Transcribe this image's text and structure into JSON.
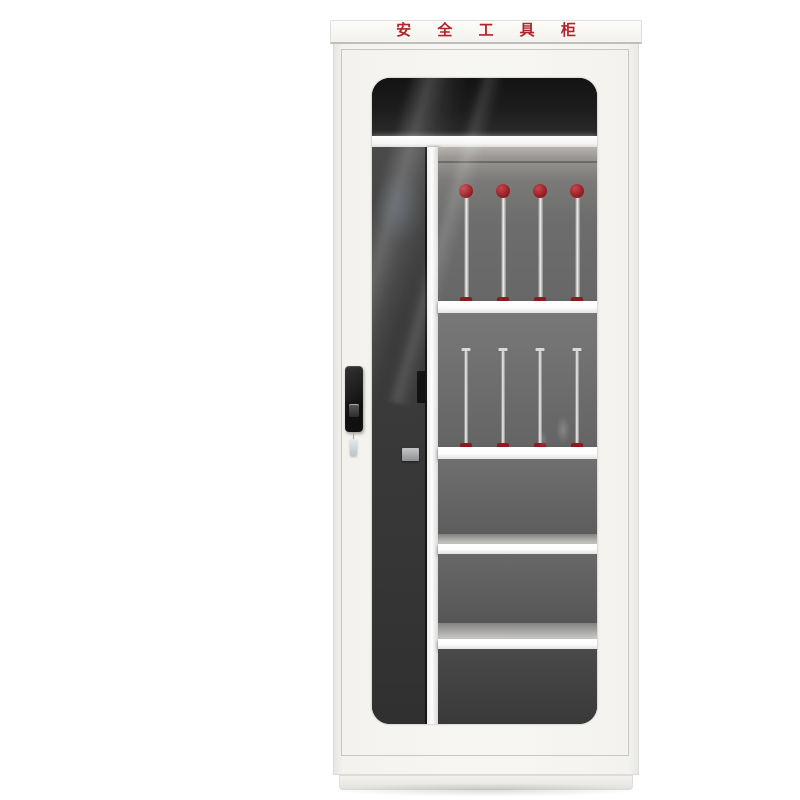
{
  "scene": {
    "description": "Product photo of a tall white electrical safety tool cabinet with a smoked-glass door",
    "background_color": "#ffffff"
  },
  "header": {
    "title": "安 全 工 具 柜",
    "title_color": "#b5232a"
  },
  "colors": {
    "cabinet_body": "#f4f3ef",
    "cabinet_edge": "#dcdbd7",
    "glass_rim": "#141414",
    "interior_top": "#1a1a1a",
    "interior_left_bay": "#3e3e3e",
    "interior_right_bay": "#696969",
    "shelf_white": "#fbfbfa",
    "rod_metal": "#c9c9c9",
    "rod_red": "#8e1b20",
    "lock_black": "#181818",
    "key_color": "#ccd5d9"
  },
  "interior": {
    "left_bay": {
      "label": "empty-tall-bay",
      "item_count": 0
    },
    "shelf_count": 5,
    "rod_rows": [
      {
        "name": "ball-top-insulated-rods",
        "count": 4
      },
      {
        "name": "flat-top-insulated-rods",
        "count": 4
      }
    ],
    "empty_right_sections": 3
  },
  "hardware": {
    "lock_label": "cam-lock-handle",
    "key_label": "hanging-key",
    "latch_label": "interior-latch"
  }
}
